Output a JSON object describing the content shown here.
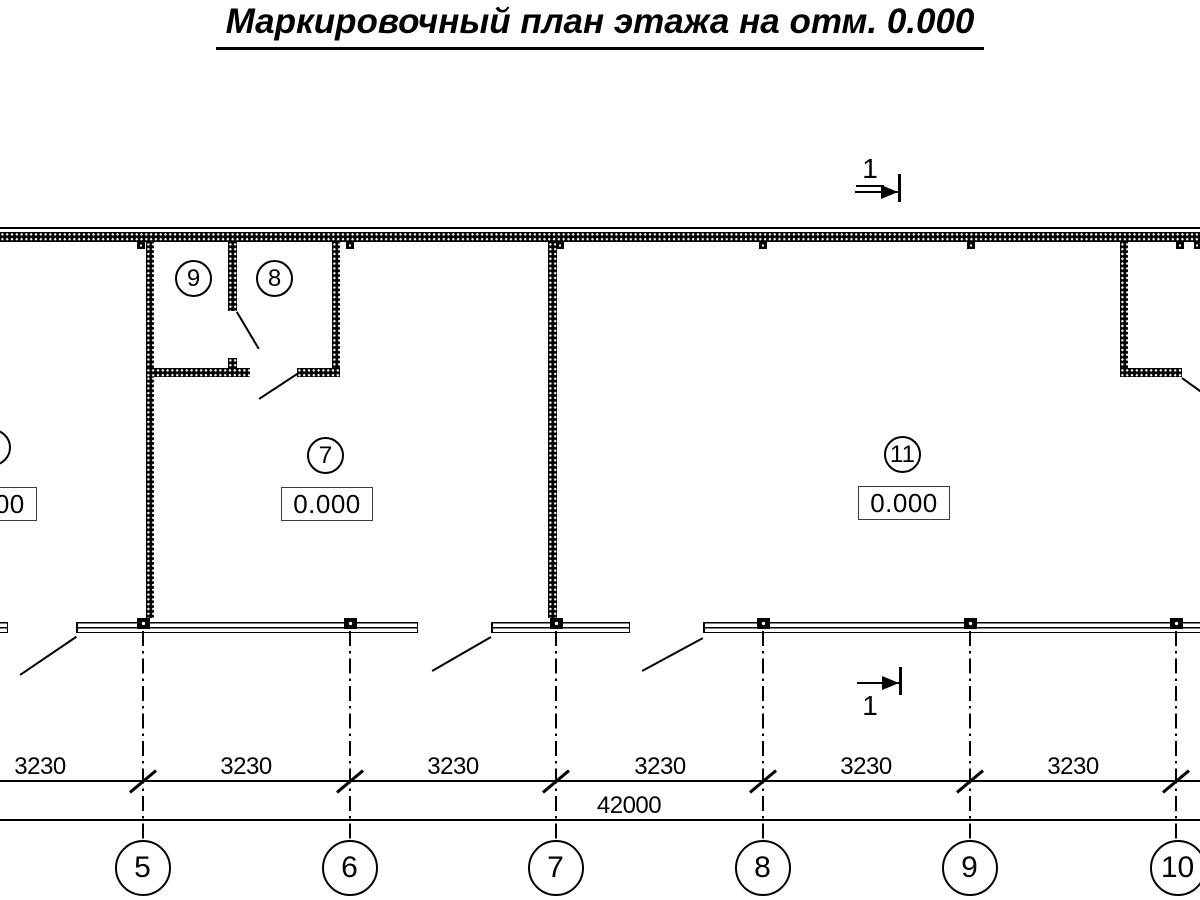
{
  "title": "Маркировочный план этажа на отм. 0.000",
  "section_mark": {
    "label": "1"
  },
  "rooms": {
    "room9": {
      "number": "9"
    },
    "room8": {
      "number": "8"
    },
    "room7": {
      "number": "7",
      "elevation": "0.000"
    },
    "room11": {
      "number": "11",
      "elevation": "0.000"
    },
    "room_left": {
      "elevation": "0.000"
    }
  },
  "dimensions": {
    "bays": [
      "3230",
      "3230",
      "3230",
      "3230",
      "3230",
      "3230"
    ],
    "total": "42000"
  },
  "grid_axes": [
    "5",
    "6",
    "7",
    "8",
    "9",
    "10"
  ],
  "colors": {
    "ink": "#000000",
    "background": "#ffffff"
  }
}
